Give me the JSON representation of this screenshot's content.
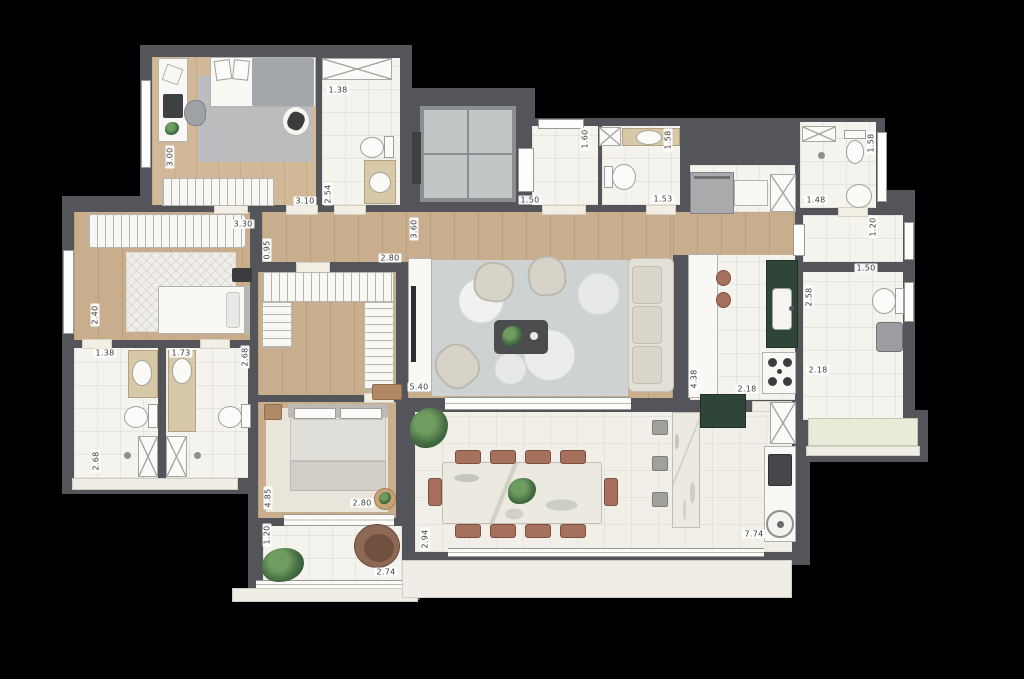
{
  "canvas": {
    "width": 1024,
    "height": 679,
    "background": "#000000"
  },
  "palette": {
    "wall": "#54555a",
    "wood_floor": "#c9ae8e",
    "tile_floor": "#f5f3ee",
    "terrace_floor": "#f1efe8",
    "vanity_beige": "#d7c8a7",
    "counter_green": "#2f4537",
    "chair_terracotta": "#a5715d",
    "rug_gray": "#babcbe",
    "rug_marble": "#ced2d3",
    "plant_green": "#446d41",
    "label_text": "#3b3b3d",
    "label_background": "#ffffff"
  },
  "dimension_labels": [
    {
      "text": "3.00",
      "x": 170,
      "y": 157,
      "o": "v"
    },
    {
      "text": "3.10",
      "x": 305,
      "y": 201,
      "o": "h"
    },
    {
      "text": "1.38",
      "x": 338,
      "y": 90,
      "o": "h"
    },
    {
      "text": "2.54",
      "x": 328,
      "y": 194,
      "o": "v"
    },
    {
      "text": "3.30",
      "x": 243,
      "y": 224,
      "o": "h"
    },
    {
      "text": "0.95",
      "x": 267,
      "y": 250,
      "o": "v"
    },
    {
      "text": "2.80",
      "x": 390,
      "y": 258,
      "o": "h"
    },
    {
      "text": "3.60",
      "x": 414,
      "y": 229,
      "o": "v"
    },
    {
      "text": "1.60",
      "x": 585,
      "y": 139,
      "o": "v"
    },
    {
      "text": "1.50",
      "x": 530,
      "y": 200,
      "o": "h"
    },
    {
      "text": "1.53",
      "x": 663,
      "y": 199,
      "o": "h"
    },
    {
      "text": "1.58",
      "x": 668,
      "y": 140,
      "o": "v"
    },
    {
      "text": "1.48",
      "x": 816,
      "y": 200,
      "o": "h"
    },
    {
      "text": "1.58",
      "x": 871,
      "y": 143,
      "o": "v"
    },
    {
      "text": "1.20",
      "x": 873,
      "y": 227,
      "o": "v"
    },
    {
      "text": "1.50",
      "x": 866,
      "y": 268,
      "o": "h"
    },
    {
      "text": "2.58",
      "x": 809,
      "y": 297,
      "o": "v"
    },
    {
      "text": "2.18",
      "x": 818,
      "y": 370,
      "o": "h"
    },
    {
      "text": "2.18",
      "x": 747,
      "y": 389,
      "o": "h"
    },
    {
      "text": "4.38",
      "x": 694,
      "y": 379,
      "o": "v"
    },
    {
      "text": "5.40",
      "x": 419,
      "y": 387,
      "o": "h"
    },
    {
      "text": "2.40",
      "x": 95,
      "y": 315,
      "o": "v"
    },
    {
      "text": "1.38",
      "x": 105,
      "y": 353,
      "o": "h"
    },
    {
      "text": "1.73",
      "x": 181,
      "y": 353,
      "o": "h"
    },
    {
      "text": "2.68",
      "x": 245,
      "y": 357,
      "o": "v"
    },
    {
      "text": "2.68",
      "x": 96,
      "y": 461,
      "o": "v"
    },
    {
      "text": "4.85",
      "x": 268,
      "y": 498,
      "o": "v"
    },
    {
      "text": "2.80",
      "x": 362,
      "y": 503,
      "o": "h"
    },
    {
      "text": "1.20",
      "x": 267,
      "y": 535,
      "o": "v"
    },
    {
      "text": "2.74",
      "x": 386,
      "y": 572,
      "o": "h"
    },
    {
      "text": "2.94",
      "x": 425,
      "y": 539,
      "o": "v"
    },
    {
      "text": "7.74",
      "x": 754,
      "y": 534,
      "o": "h"
    }
  ]
}
